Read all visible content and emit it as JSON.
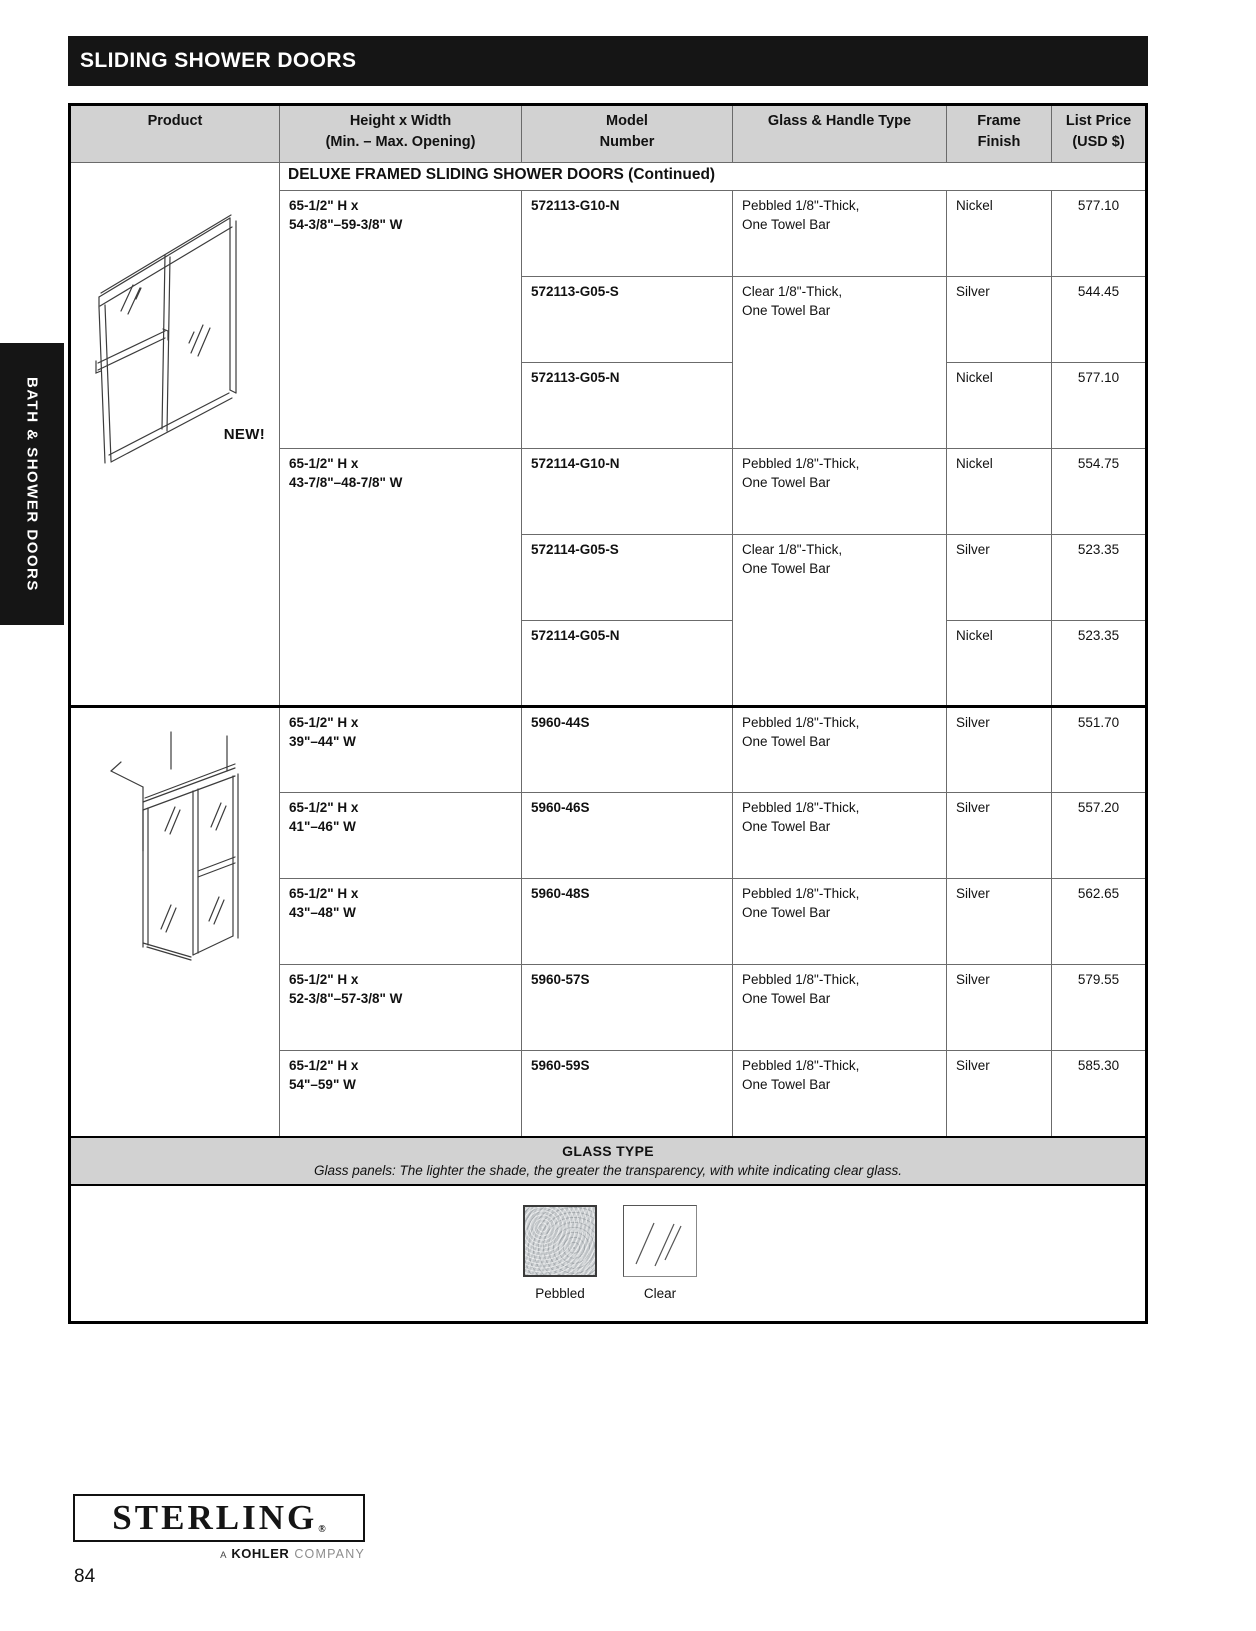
{
  "page": {
    "title": "SLIDING SHOWER DOORS",
    "sidebar_label": "BATH & SHOWER DOORS",
    "number": "84"
  },
  "table": {
    "headers": {
      "product": "Product",
      "height": "Height x Width\n(Min. – Max. Opening)",
      "model": "Model\nNumber",
      "glass": "Glass & Handle Type",
      "finish": "Frame\nFinish",
      "price": "List Price\n(USD $)"
    },
    "section_header": "DELUXE FRAMED SLIDING SHOWER DOORS (Continued)",
    "new_badge": "NEW!",
    "rows": [
      {
        "height": "65-1/2\" H x\n54-3/8\"–59-3/8\" W",
        "model": "572113-G10-N",
        "glass": "Pebbled 1/8\"-Thick,\nOne Towel Bar",
        "finish": "Nickel",
        "price": "577.10"
      },
      {
        "model": "572113-G05-S",
        "glass": "Clear 1/8\"-Thick,\nOne Towel Bar",
        "finish": "Silver",
        "price": "544.45"
      },
      {
        "model": "572113-G05-N",
        "finish": "Nickel",
        "price": "577.10"
      },
      {
        "height": "65-1/2\" H x\n43-7/8\"–48-7/8\" W",
        "model": "572114-G10-N",
        "glass": "Pebbled 1/8\"-Thick,\nOne Towel Bar",
        "finish": "Nickel",
        "price": "554.75"
      },
      {
        "model": "572114-G05-S",
        "glass": "Clear 1/8\"-Thick,\nOne Towel Bar",
        "finish": "Silver",
        "price": "523.35"
      },
      {
        "model": "572114-G05-N",
        "finish": "Nickel",
        "price": "523.35"
      },
      {
        "height": "65-1/2\" H x\n39\"–44\" W",
        "model": "5960-44S",
        "glass": "Pebbled 1/8\"-Thick,\nOne Towel Bar",
        "finish": "Silver",
        "price": "551.70"
      },
      {
        "height": "65-1/2\" H x\n41\"–46\" W",
        "model": "5960-46S",
        "glass": "Pebbled 1/8\"-Thick,\nOne Towel Bar",
        "finish": "Silver",
        "price": "557.20"
      },
      {
        "height": "65-1/2\" H x\n43\"–48\" W",
        "model": "5960-48S",
        "glass": "Pebbled 1/8\"-Thick,\nOne Towel Bar",
        "finish": "Silver",
        "price": "562.65"
      },
      {
        "height": "65-1/2\" H x\n52-3/8\"–57-3/8\" W",
        "model": "5960-57S",
        "glass": "Pebbled 1/8\"-Thick,\nOne Towel Bar",
        "finish": "Silver",
        "price": "579.55"
      },
      {
        "height": "65-1/2\" H x\n54\"–59\" W",
        "model": "5960-59S",
        "glass": "Pebbled 1/8\"-Thick,\nOne Towel Bar",
        "finish": "Silver",
        "price": "585.30"
      }
    ]
  },
  "glass_type": {
    "title": "GLASS TYPE",
    "description": "Glass panels: The lighter the shade, the greater the transparency, with white indicating clear glass.",
    "swatches": [
      {
        "label": "Pebbled"
      },
      {
        "label": "Clear"
      }
    ]
  },
  "logo": {
    "brand": "STERLING",
    "registered": "®",
    "tagline_a": "A",
    "tagline_kohler": "KOHLER",
    "tagline_company": "COMPANY"
  },
  "colors": {
    "header_bg": "#d2d2d2",
    "title_bar_bg": "#151515",
    "accent_text": "#111111"
  }
}
